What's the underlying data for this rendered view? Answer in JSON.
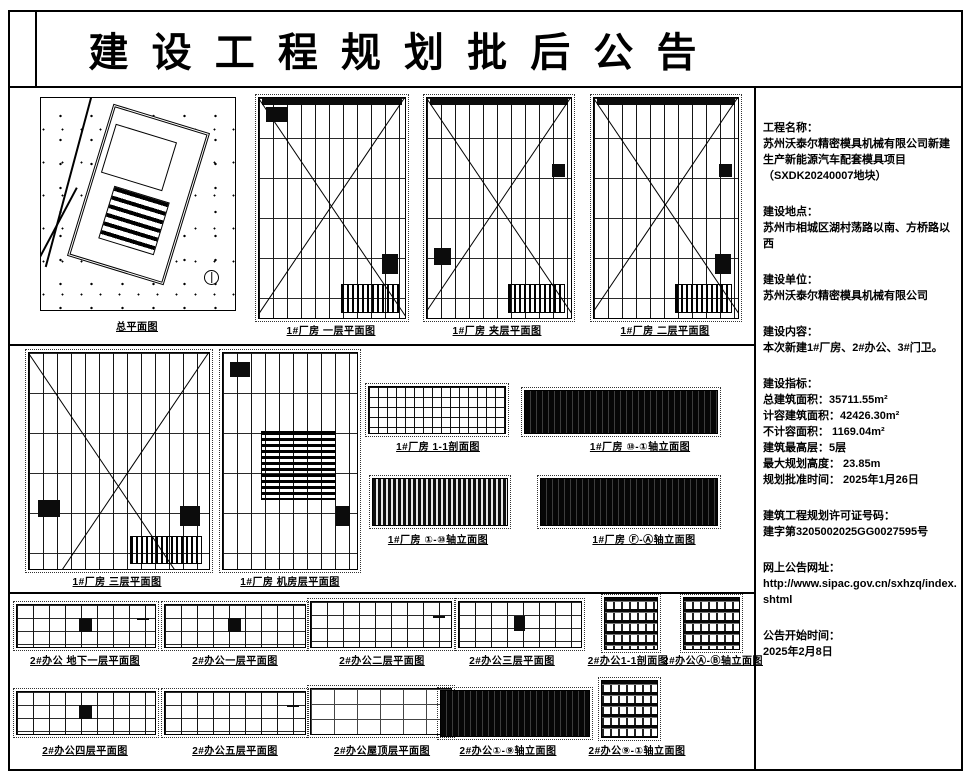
{
  "title": "建 设 工 程 规 划 批 后 公 告",
  "info": {
    "project_name_label": "工程名称：",
    "project_name": "苏州沃泰尔精密模具机械有限公司新建生产新能源汽车配套模具项目",
    "parcel": "（SXDK20240007地块）",
    "location_label": "建设地点：",
    "location": "苏州市相城区湖村荡路以南、方桥路以西",
    "builder_label": "建设单位：",
    "builder": "苏州沃泰尔精密模具机械有限公司",
    "content_label": "建设内容：",
    "content": "本次新建1#厂房、2#办公、3#门卫。",
    "metrics_label": "建设指标：",
    "metrics": [
      "总建筑面积：35711.55m²",
      "计容建筑面积：42426.30m²",
      "不计容面积： 1169.04m²",
      "建筑最高层：5层",
      "最大规划高度： 23.85m",
      "规划批准时间： 2025年1月26日"
    ],
    "permit_label": "建筑工程规划许可证号码：",
    "permit_no": "建字第3205002025GG0027595号",
    "url_label": "网上公告网址：",
    "url": "http://www.sipac.gov.cn/sxhzq/index.shtml",
    "start_label": "公告开始时间：",
    "start_date": "2025年2月8日"
  },
  "captions": {
    "site": "总平面图",
    "f1_floor1": "1#厂房 一层平面图",
    "f1_mezz": "1#厂房 夹层平面图",
    "f1_floor2": "1#厂房 二层平面图",
    "f1_floor3": "1#厂房 三层平面图",
    "f1_machine": "1#厂房 机房层平面图",
    "f1_section": "1#厂房 1-1剖面图",
    "f1_elev_a": "1#厂房 ⑩-①轴立面图",
    "f1_elev_b": "1#厂房 ①-⑩轴立面图",
    "f1_elev_c": "1#厂房 Ⓕ-Ⓐ轴立面图",
    "o2_b1": "2#办公 地下一层平面图",
    "o2_f1": "2#办公一层平面图",
    "o2_f2": "2#办公二层平面图",
    "o2_f3": "2#办公三层平面图",
    "o2_section": "2#办公1-1剖面图",
    "o2_elev_ab": "2#办公Ⓐ-Ⓑ轴立面图",
    "o2_f4": "2#办公四层平面图",
    "o2_f5": "2#办公五层平面图",
    "o2_roof": "2#办公屋顶层平面图",
    "o2_elev_19": "2#办公①-⑨轴立面图",
    "o2_elev_91": "2#办公⑨-①轴立面图"
  },
  "colors": {
    "ink": "#000000",
    "paper": "#ffffff"
  }
}
